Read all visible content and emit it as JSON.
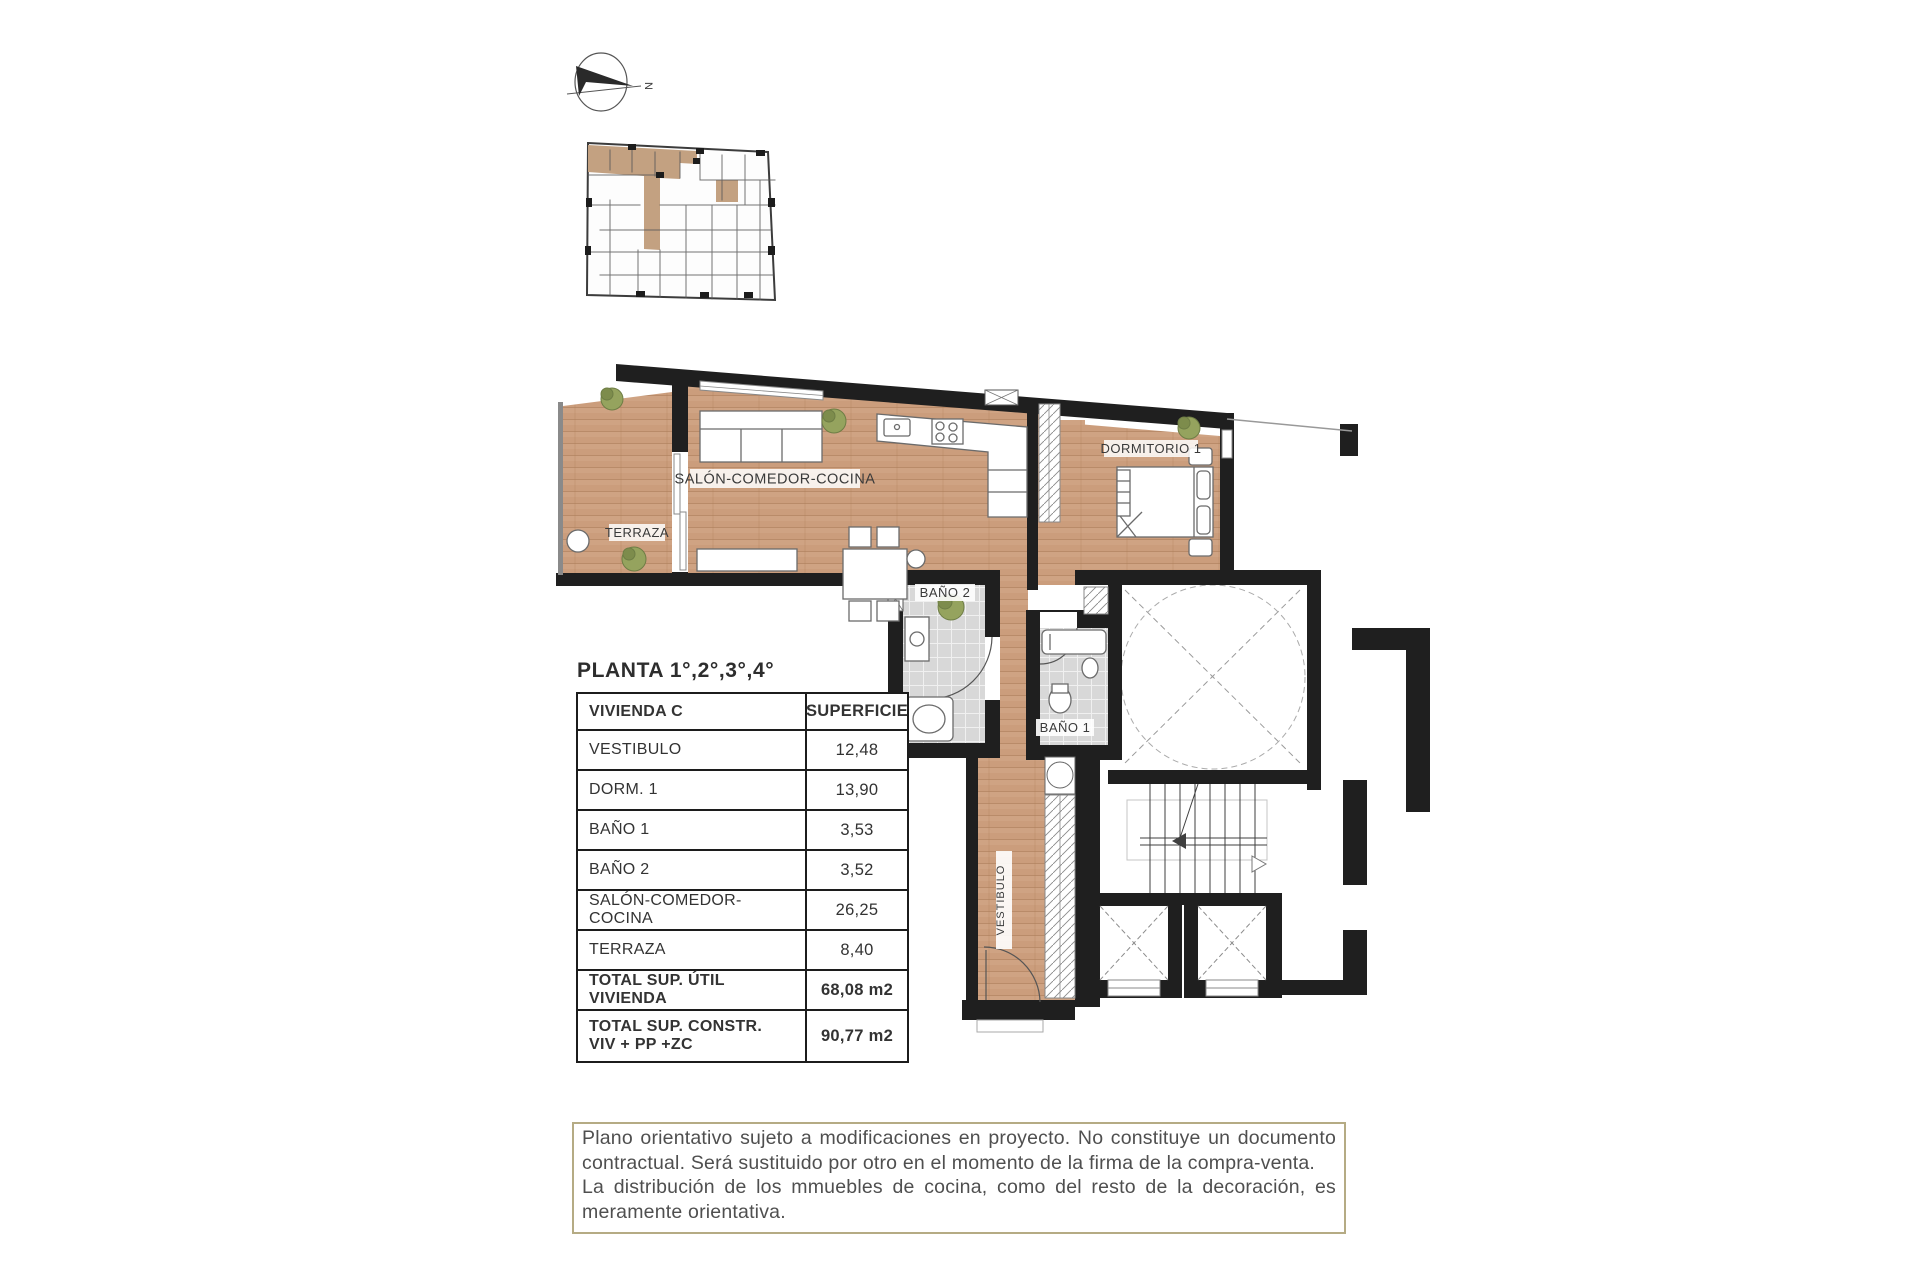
{
  "compass": {
    "north_label": "N"
  },
  "plan": {
    "rooms": {
      "terraza": "TERRAZA",
      "salon": "SALÓN-COMEDOR-COCINA",
      "dormitorio": "DORMITORIO 1",
      "bano2": "BAÑO 2",
      "bano1": "BAÑO 1",
      "vestibulo": "VESTIBULO"
    }
  },
  "table": {
    "title": "PLANTA 1°,2°,3°,4°",
    "header": {
      "name": "VIVIENDA C",
      "value": "SUPERFICIE"
    },
    "rows": [
      {
        "label": "VESTIBULO",
        "value": "12,48"
      },
      {
        "label": "DORM. 1",
        "value": "13,90"
      },
      {
        "label": "BAÑO 1",
        "value": "3,53"
      },
      {
        "label": "BAÑO 2",
        "value": "3,52"
      },
      {
        "label": "SALÓN-COMEDOR-COCINA",
        "value": "26,25"
      },
      {
        "label": "TERRAZA",
        "value": "8,40"
      }
    ],
    "totals": [
      {
        "label": "TOTAL SUP. ÚTIL VIVIENDA",
        "value": "68,08 m2"
      },
      {
        "label_line1": "TOTAL SUP. CONSTR.",
        "label_line2": "VIV + PP +ZC",
        "value": "90,77 m2"
      }
    ]
  },
  "disclaimer": {
    "paragraph1": "Plano orientativo sujeto a modificaciones en proyecto. No constituye un documento contractual. Será sustituido por otro en el momento de la firma de la compra-venta.",
    "paragraph2": "La distribución de los mmuebles de cocina, como del resto de la decoración, es meramente orientativa."
  },
  "colors": {
    "wood": "#cb9d7c",
    "highlight_unit": "#c3a181",
    "wall": "#1f1f1f",
    "tile": "#d8d8d8",
    "disclaimer_border": "#b5ab84"
  }
}
